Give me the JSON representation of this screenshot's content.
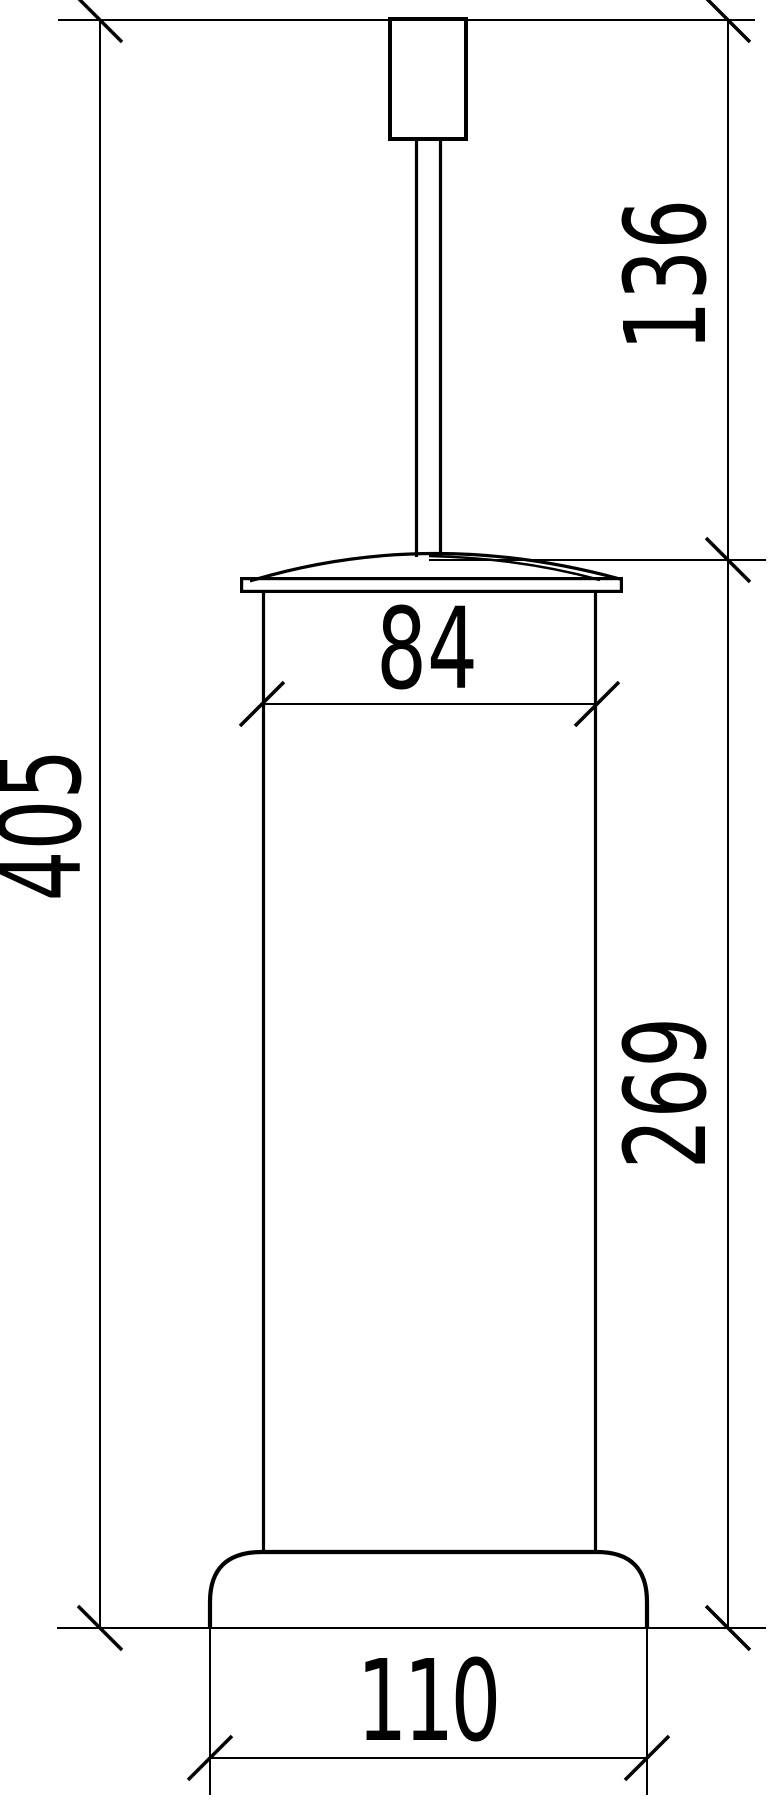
{
  "diagram": {
    "type": "technical-dimension-drawing",
    "subject": "floor-standing toilet brush holder, front elevation with dimensions",
    "background_color": "#ffffff",
    "line_color": "#000000",
    "units_shown": "none",
    "labels": {
      "overall_height": "405",
      "handle_height": "136",
      "container_width": "84",
      "container_height": "269",
      "base_width": "110"
    }
  }
}
